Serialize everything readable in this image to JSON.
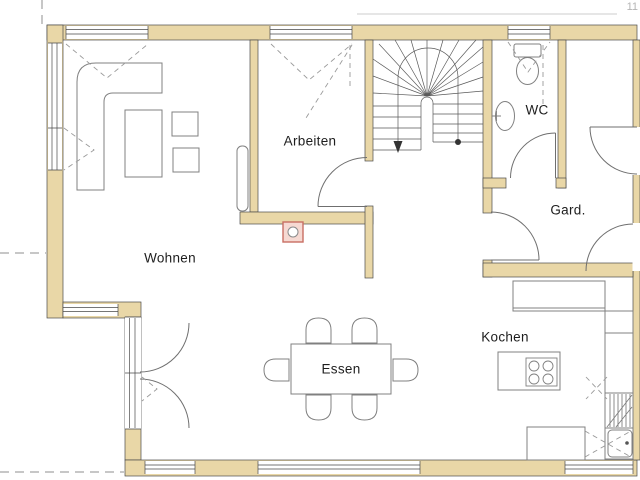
{
  "page": {
    "number": "11"
  },
  "rooms": [
    {
      "id": "wohnen",
      "label": "Wohnen"
    },
    {
      "id": "arbeiten",
      "label": "Arbeiten"
    },
    {
      "id": "wc",
      "label": "WC"
    },
    {
      "id": "gard",
      "label": "Gard."
    },
    {
      "id": "essen",
      "label": "Essen"
    },
    {
      "id": "kochen",
      "label": "Kochen"
    }
  ],
  "symbols": {
    "circle_marker": "circle-in-pink-square"
  },
  "colors": {
    "wall": "#e9d7a7",
    "line": "#4a4a4a",
    "furniture": "#808080",
    "dashed": "#9a9a9a",
    "symbol_border": "#c96f63",
    "symbol_fill": "#f6d9d2",
    "page_number": "#b5b5b5"
  }
}
